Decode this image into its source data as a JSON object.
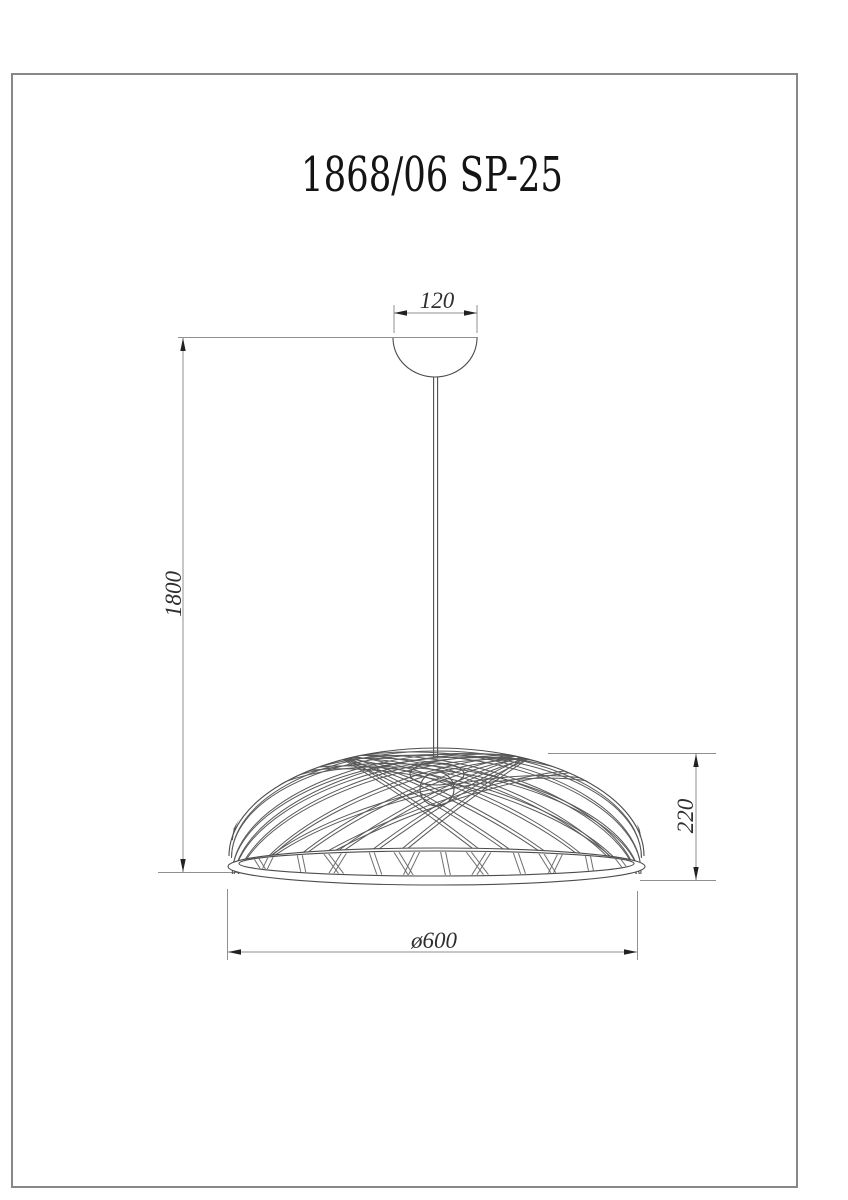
{
  "title": "1868/06 SP-25",
  "dimensions": {
    "canopy_width": "120",
    "cord_drop": "1800",
    "shade_height": "220",
    "shade_diameter": "ø600"
  },
  "colors": {
    "border": "#878787",
    "dim_line": "#8f8f8f",
    "arrow": "#222222",
    "ink": "#4d4d4d",
    "strand": "#5a5a5a",
    "back_strand": "#6e6e6e",
    "text": "#2e2e2e",
    "title_text": "#141414"
  }
}
